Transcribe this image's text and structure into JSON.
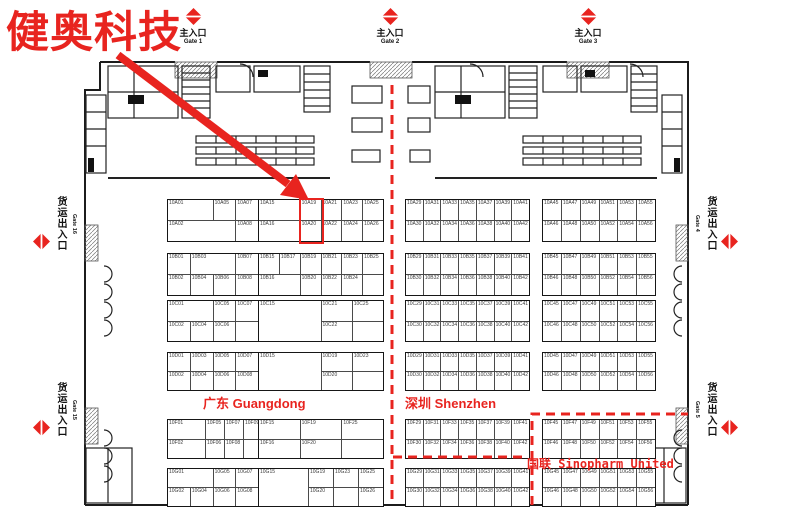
{
  "annotation": {
    "company": "健奥科技",
    "highlight": {
      "booths": [
        "10A19",
        "10A20"
      ]
    }
  },
  "colors": {
    "accent": "#e8241f",
    "wall": "#1c1c1c",
    "grid": "#4a4a4a"
  },
  "gates": {
    "top": [
      {
        "label_zh": "主入口",
        "label_en": "Gate 1"
      },
      {
        "label_zh": "主入口",
        "label_en": "Gate 2"
      },
      {
        "label_zh": "主入口",
        "label_en": "Gate 3"
      }
    ],
    "left": [
      {
        "label_zh": "货运出入口",
        "label_en": "Gate 16"
      },
      {
        "label_zh": "货运出入口",
        "label_en": "Gate 15"
      }
    ],
    "right": [
      {
        "label_zh": "货运出入口",
        "label_en": "Gate 4"
      },
      {
        "label_zh": "货运出入口",
        "label_en": "Gate 5"
      }
    ]
  },
  "region_labels": {
    "guangdong": {
      "zh": "广东",
      "en": "Guangdong"
    },
    "shenzhen": {
      "zh": "深圳",
      "en": "Shenzhen"
    },
    "sinopharm": {
      "zh": "国联",
      "en": "Sinopharm United"
    }
  },
  "booth_blocks": [
    {
      "id": "A-L1",
      "x": 167,
      "y": 199,
      "w": 113,
      "h": 41,
      "cols": 5,
      "rows": [
        [
          {
            "t": "10A01",
            "c": 2
          },
          {
            "t": "10A05"
          },
          {
            "t": "10A07"
          },
          {
            "t": "10A09"
          }
        ],
        [
          {
            "t": "10A02",
            "c": 3
          },
          {
            "t": "10A08"
          },
          {
            "t": "10A10"
          }
        ]
      ]
    },
    {
      "id": "A-L2",
      "x": 258,
      "y": 199,
      "w": 124,
      "h": 41,
      "cols": 6,
      "rows": [
        [
          {
            "t": "10A15",
            "c": 2
          },
          {
            "t": "10A19"
          },
          {
            "t": "10A21"
          },
          {
            "t": "10A23"
          },
          {
            "t": "10A25"
          }
        ],
        [
          {
            "t": "10A16",
            "c": 2
          },
          {
            "t": "10A20"
          },
          {
            "t": "10A22"
          },
          {
            "t": "10A24"
          },
          {
            "t": "10A26"
          }
        ]
      ]
    },
    {
      "id": "A-R1",
      "x": 405,
      "y": 199,
      "w": 123,
      "h": 41,
      "cols": 7,
      "rows": [
        [
          {
            "t": "10A29"
          },
          {
            "t": "10A31"
          },
          {
            "t": "10A33"
          },
          {
            "t": "10A35"
          },
          {
            "t": "10A37"
          },
          {
            "t": "10A39"
          },
          {
            "t": "10A41"
          }
        ],
        [
          {
            "t": "10A30"
          },
          {
            "t": "10A32"
          },
          {
            "t": "10A34"
          },
          {
            "t": "10A36"
          },
          {
            "t": "10A38"
          },
          {
            "t": "10A40"
          },
          {
            "t": "10A42"
          }
        ]
      ]
    },
    {
      "id": "A-R2",
      "x": 542,
      "y": 199,
      "w": 112,
      "h": 41,
      "cols": 6,
      "rows": [
        [
          {
            "t": "10A45"
          },
          {
            "t": "10A47"
          },
          {
            "t": "10A49"
          },
          {
            "t": "10A51"
          },
          {
            "t": "10A53"
          },
          {
            "t": "10A55"
          }
        ],
        [
          {
            "t": "10A46"
          },
          {
            "t": "10A48"
          },
          {
            "t": "10A50"
          },
          {
            "t": "10A52"
          },
          {
            "t": "10A54"
          },
          {
            "t": "10A56"
          }
        ]
      ]
    },
    {
      "id": "B-L1",
      "x": 167,
      "y": 253,
      "w": 113,
      "h": 41,
      "cols": 5,
      "rows": [
        [
          {
            "t": "10B01"
          },
          {
            "t": "10B03",
            "c": 2
          },
          {
            "t": "10B07"
          },
          {
            "t": "10B09"
          }
        ],
        [
          {
            "t": "10B02"
          },
          {
            "t": "10B04"
          },
          {
            "t": "10B06"
          },
          {
            "t": "10B08"
          },
          {
            "t": "10B10"
          }
        ]
      ]
    },
    {
      "id": "B-L2",
      "x": 258,
      "y": 253,
      "w": 124,
      "h": 41,
      "cols": 6,
      "rows": [
        [
          {
            "t": "10B15"
          },
          {
            "t": "10B17"
          },
          {
            "t": "10B19"
          },
          {
            "t": "10B21"
          },
          {
            "t": "10B23"
          },
          {
            "t": "10B25"
          }
        ],
        [
          {
            "t": "10B16",
            "c": 2
          },
          {
            "t": "10B20"
          },
          {
            "t": "10B22"
          },
          {
            "t": "10B24"
          },
          {
            "t": ""
          }
        ]
      ]
    },
    {
      "id": "B-R1",
      "x": 405,
      "y": 253,
      "w": 123,
      "h": 41,
      "cols": 7,
      "rows": [
        [
          {
            "t": "10B29"
          },
          {
            "t": "10B31"
          },
          {
            "t": "10B33"
          },
          {
            "t": "10B35"
          },
          {
            "t": "10B37"
          },
          {
            "t": "10B39"
          },
          {
            "t": "10B41"
          }
        ],
        [
          {
            "t": "10B30"
          },
          {
            "t": "10B32"
          },
          {
            "t": "10B34"
          },
          {
            "t": "10B36"
          },
          {
            "t": "10B38"
          },
          {
            "t": "10B40"
          },
          {
            "t": "10B42"
          }
        ]
      ]
    },
    {
      "id": "B-R2",
      "x": 542,
      "y": 253,
      "w": 112,
      "h": 41,
      "cols": 6,
      "rows": [
        [
          {
            "t": "10B45"
          },
          {
            "t": "10B47"
          },
          {
            "t": "10B49"
          },
          {
            "t": "10B51"
          },
          {
            "t": "10B53"
          },
          {
            "t": "10B55"
          }
        ],
        [
          {
            "t": "10B46"
          },
          {
            "t": "10B48"
          },
          {
            "t": "10B50"
          },
          {
            "t": "10B52"
          },
          {
            "t": "10B54"
          },
          {
            "t": "10B56"
          }
        ]
      ]
    },
    {
      "id": "C-L1",
      "x": 167,
      "y": 300,
      "w": 113,
      "h": 40,
      "cols": 5,
      "rows": [
        [
          {
            "t": "10C01",
            "c": 2
          },
          {
            "t": "10C05"
          },
          {
            "t": "10C07",
            "c": 2
          }
        ],
        [
          {
            "t": "10C02"
          },
          {
            "t": "10C04"
          },
          {
            "t": "10C06"
          },
          {
            "t": "",
            "c": 2
          }
        ]
      ]
    },
    {
      "id": "C-L2",
      "x": 258,
      "y": 300,
      "w": 124,
      "h": 40,
      "cols": 4,
      "rows": [
        [
          {
            "t": "10C15",
            "c": 2,
            "r": 2
          },
          {
            "t": "10C21"
          },
          {
            "t": "10C25"
          }
        ],
        [
          {
            "t": "10C22"
          },
          {
            "t": ""
          }
        ]
      ]
    },
    {
      "id": "C-R1",
      "x": 405,
      "y": 300,
      "w": 123,
      "h": 40,
      "cols": 7,
      "rows": [
        [
          {
            "t": "10C29"
          },
          {
            "t": "10C31"
          },
          {
            "t": "10C33"
          },
          {
            "t": "10C35"
          },
          {
            "t": "10C37"
          },
          {
            "t": "10C39"
          },
          {
            "t": "10C41"
          }
        ],
        [
          {
            "t": "10C30"
          },
          {
            "t": "10C32"
          },
          {
            "t": "10C34"
          },
          {
            "t": "10C36"
          },
          {
            "t": "10C38"
          },
          {
            "t": "10C40"
          },
          {
            "t": "10C42"
          }
        ]
      ]
    },
    {
      "id": "C-R2",
      "x": 542,
      "y": 300,
      "w": 112,
      "h": 40,
      "cols": 6,
      "rows": [
        [
          {
            "t": "10C45"
          },
          {
            "t": "10C47"
          },
          {
            "t": "10C49"
          },
          {
            "t": "10C51"
          },
          {
            "t": "10C53"
          },
          {
            "t": "10C55"
          }
        ],
        [
          {
            "t": "10C46"
          },
          {
            "t": "10C48"
          },
          {
            "t": "10C50"
          },
          {
            "t": "10C52"
          },
          {
            "t": "10C54"
          },
          {
            "t": "10C56"
          }
        ]
      ]
    },
    {
      "id": "D-L1",
      "x": 167,
      "y": 352,
      "w": 113,
      "h": 37,
      "cols": 5,
      "rows": [
        [
          {
            "t": "10D01"
          },
          {
            "t": "10D03"
          },
          {
            "t": "10D05"
          },
          {
            "t": "10D07"
          },
          {
            "t": "10D09"
          }
        ],
        [
          {
            "t": "10D02"
          },
          {
            "t": "10D04"
          },
          {
            "t": "10D06"
          },
          {
            "t": "10D08"
          },
          {
            "t": ""
          }
        ]
      ]
    },
    {
      "id": "D-L2",
      "x": 258,
      "y": 352,
      "w": 124,
      "h": 37,
      "cols": 4,
      "rows": [
        [
          {
            "t": "10D15",
            "c": 2,
            "r": 2
          },
          {
            "t": "10D19"
          },
          {
            "t": "10D23"
          }
        ],
        [
          {
            "t": "10D20"
          },
          {
            "t": ""
          }
        ]
      ]
    },
    {
      "id": "D-R1",
      "x": 405,
      "y": 352,
      "w": 123,
      "h": 37,
      "cols": 7,
      "rows": [
        [
          {
            "t": "10D29"
          },
          {
            "t": "10D31"
          },
          {
            "t": "10D33"
          },
          {
            "t": "10D35"
          },
          {
            "t": "10D37"
          },
          {
            "t": "10D39"
          },
          {
            "t": "10D41"
          }
        ],
        [
          {
            "t": "10D30"
          },
          {
            "t": "10D32"
          },
          {
            "t": "10D34"
          },
          {
            "t": "10D36"
          },
          {
            "t": "10D38"
          },
          {
            "t": "10D40"
          },
          {
            "t": "10D42"
          }
        ]
      ]
    },
    {
      "id": "D-R2",
      "x": 542,
      "y": 352,
      "w": 112,
      "h": 37,
      "cols": 6,
      "rows": [
        [
          {
            "t": "10D45"
          },
          {
            "t": "10D47"
          },
          {
            "t": "10D49"
          },
          {
            "t": "10D51"
          },
          {
            "t": "10D53"
          },
          {
            "t": "10D55"
          }
        ],
        [
          {
            "t": "10D46"
          },
          {
            "t": "10D48"
          },
          {
            "t": "10D50"
          },
          {
            "t": "10D52"
          },
          {
            "t": "10D54"
          },
          {
            "t": "10D56"
          }
        ]
      ]
    },
    {
      "id": "F-L1",
      "x": 167,
      "y": 419,
      "w": 113,
      "h": 38,
      "cols": 6,
      "rows": [
        [
          {
            "t": "10F01",
            "c": 2
          },
          {
            "t": "10F05"
          },
          {
            "t": "10F07"
          },
          {
            "t": "10F09",
            "c": 2
          }
        ],
        [
          {
            "t": "10F02",
            "c": 2
          },
          {
            "t": "10F06"
          },
          {
            "t": "10F08"
          },
          {
            "t": "",
            "c": 2
          }
        ]
      ]
    },
    {
      "id": "F-L2",
      "x": 258,
      "y": 419,
      "w": 124,
      "h": 38,
      "cols": 3,
      "rows": [
        [
          {
            "t": "10F15"
          },
          {
            "t": "10F19"
          },
          {
            "t": "10F25"
          }
        ],
        [
          {
            "t": "10F16"
          },
          {
            "t": "10F20"
          },
          {
            "t": ""
          }
        ]
      ]
    },
    {
      "id": "F-R1",
      "x": 405,
      "y": 419,
      "w": 123,
      "h": 38,
      "cols": 7,
      "rows": [
        [
          {
            "t": "10F29"
          },
          {
            "t": "10F31"
          },
          {
            "t": "10F33"
          },
          {
            "t": "10F35"
          },
          {
            "t": "10F37"
          },
          {
            "t": "10F39"
          },
          {
            "t": "10F41"
          }
        ],
        [
          {
            "t": "10F30"
          },
          {
            "t": "10F32"
          },
          {
            "t": "10F34"
          },
          {
            "t": "10F36"
          },
          {
            "t": "10F38"
          },
          {
            "t": "10F40"
          },
          {
            "t": "10F42"
          }
        ]
      ]
    },
    {
      "id": "F-R2",
      "x": 542,
      "y": 419,
      "w": 112,
      "h": 38,
      "cols": 6,
      "rows": [
        [
          {
            "t": "10F45"
          },
          {
            "t": "10F47"
          },
          {
            "t": "10F49"
          },
          {
            "t": "10F51"
          },
          {
            "t": "10F53"
          },
          {
            "t": "10F55"
          }
        ],
        [
          {
            "t": "10F46"
          },
          {
            "t": "10F48"
          },
          {
            "t": "10F50"
          },
          {
            "t": "10F52"
          },
          {
            "t": "10F54"
          },
          {
            "t": "10F56"
          }
        ]
      ]
    },
    {
      "id": "G-L1",
      "x": 167,
      "y": 468,
      "w": 113,
      "h": 37,
      "cols": 5,
      "rows": [
        [
          {
            "t": "10G01",
            "c": 2
          },
          {
            "t": "10G05"
          },
          {
            "t": "10G07"
          },
          {
            "t": "10G09"
          }
        ],
        [
          {
            "t": "10G02"
          },
          {
            "t": "10G04"
          },
          {
            "t": "10G06"
          },
          {
            "t": "10G08"
          },
          {
            "t": "10G10"
          }
        ]
      ]
    },
    {
      "id": "G-L2",
      "x": 258,
      "y": 468,
      "w": 124,
      "h": 37,
      "cols": 5,
      "rows": [
        [
          {
            "t": "10G15",
            "c": 2,
            "r": 2
          },
          {
            "t": "10G19"
          },
          {
            "t": "10G23"
          },
          {
            "t": "10G25"
          }
        ],
        [
          {
            "t": "10G20"
          },
          {
            "t": ""
          },
          {
            "t": "10G26"
          }
        ]
      ]
    },
    {
      "id": "G-R1",
      "x": 405,
      "y": 468,
      "w": 123,
      "h": 37,
      "cols": 7,
      "rows": [
        [
          {
            "t": "10G29"
          },
          {
            "t": "10G31"
          },
          {
            "t": "10G33"
          },
          {
            "t": "10G35"
          },
          {
            "t": "10G37"
          },
          {
            "t": "10G39"
          },
          {
            "t": "10G41"
          }
        ],
        [
          {
            "t": "10G30"
          },
          {
            "t": "10G32"
          },
          {
            "t": "10G34"
          },
          {
            "t": "10G36"
          },
          {
            "t": "10G38"
          },
          {
            "t": "10G40"
          },
          {
            "t": "10G42"
          }
        ]
      ]
    },
    {
      "id": "G-R2",
      "x": 542,
      "y": 468,
      "w": 112,
      "h": 37,
      "cols": 6,
      "rows": [
        [
          {
            "t": "10G45"
          },
          {
            "t": "10G47"
          },
          {
            "t": "10G49"
          },
          {
            "t": "10G51"
          },
          {
            "t": "10G53"
          },
          {
            "t": "10G55"
          }
        ],
        [
          {
            "t": "10G46"
          },
          {
            "t": "10G48"
          },
          {
            "t": "10G50"
          },
          {
            "t": "10G52"
          },
          {
            "t": "10G54"
          },
          {
            "t": "10G56"
          }
        ]
      ]
    }
  ]
}
